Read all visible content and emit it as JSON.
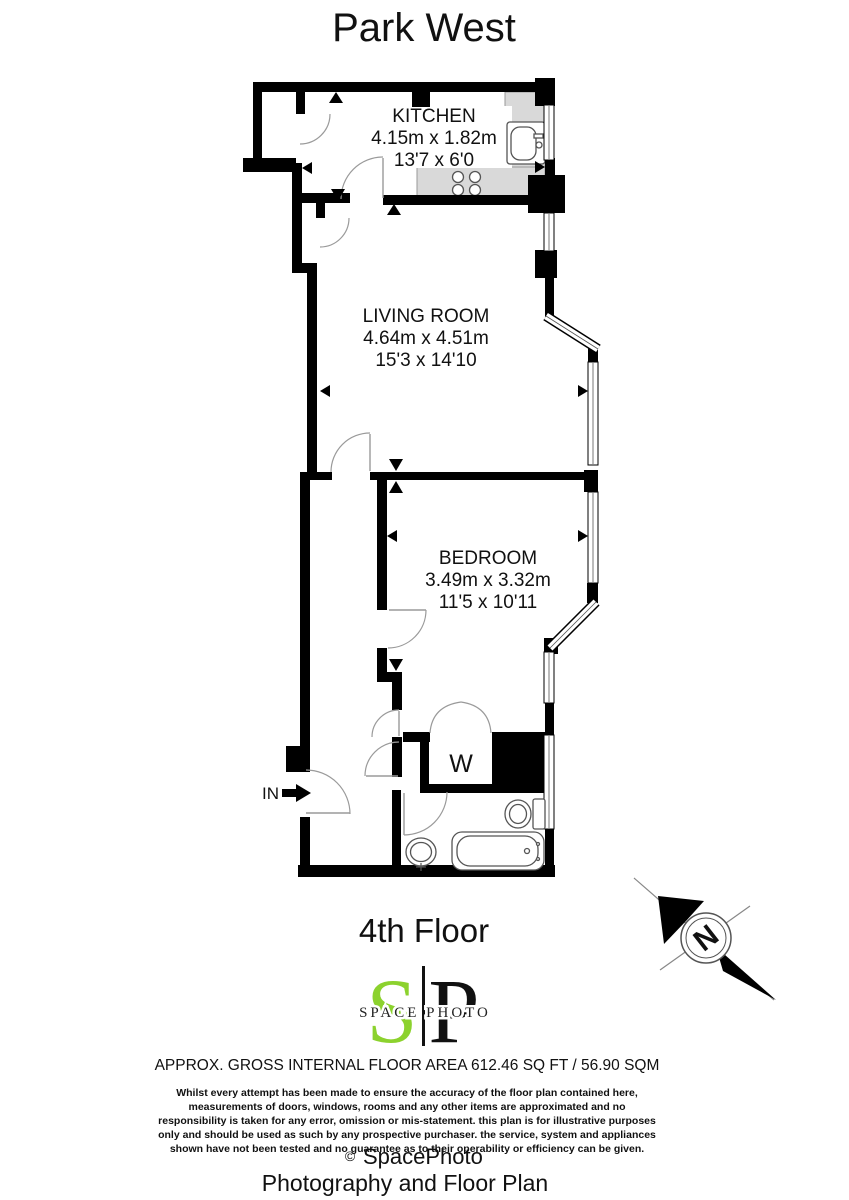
{
  "title": "Park West",
  "floor_label": "4th Floor",
  "plan": {
    "rooms": [
      {
        "name": "KITCHEN",
        "metric": "4.15m x 1.82m",
        "imperial": "13'7 x 6'0"
      },
      {
        "name": "LIVING ROOM",
        "metric": "4.64m x 4.51m",
        "imperial": "15'3 x 14'10"
      },
      {
        "name": "BEDROOM",
        "metric": "3.49m x 3.32m",
        "imperial": "11'5 x 10'11"
      }
    ],
    "wardrobe_label": "W",
    "entrance_label": "IN",
    "compass_label": "N"
  },
  "logo": {
    "letter_s": "S",
    "letter_p": "P",
    "text": "SPACE PHOTO",
    "green": "#8cd22e"
  },
  "footer": {
    "area_line": "APPROX. GROSS INTERNAL FLOOR AREA 612.46 SQ FT / 56.90 SQM",
    "disclaimer": [
      "Whilst every attempt has been made to ensure the accuracy of the floor plan contained here,",
      "measurements of doors, windows, rooms and any other items are approximated and no",
      "responsibility is taken for any error, omission or mis-statement. this plan is for illustrative purposes",
      "only and should be used as such by any prospective purchaser. the service, system and appliances",
      "shown have not been tested and no guarantee as to their operability or efficiency can be given."
    ],
    "copyright_symbol": "©",
    "copyright_name": "SpacePhoto",
    "tagline": "Photography and Floor Plan"
  }
}
